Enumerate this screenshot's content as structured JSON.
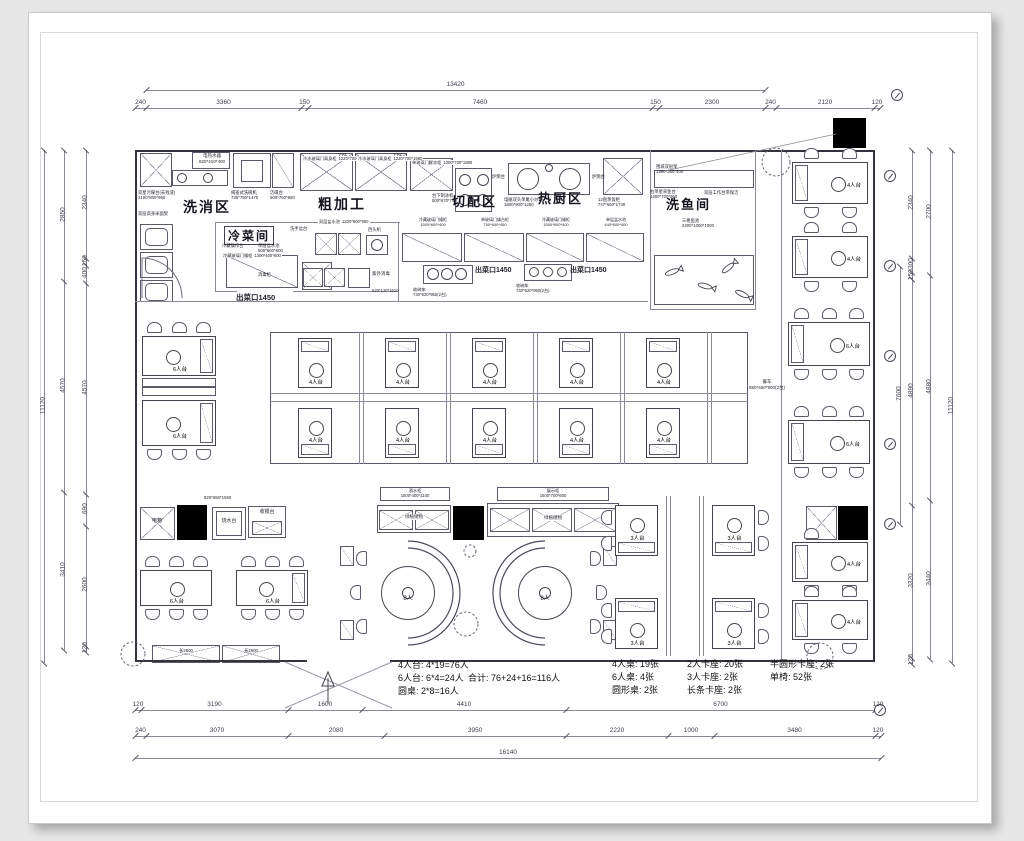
{
  "zones": {
    "wash": "洗消区",
    "cold": "冷菜间",
    "rough": "粗加工",
    "cut": "切配区",
    "hot": "热厨区",
    "fish": "洗鱼间"
  },
  "openings": {
    "serve": "出菜口1450"
  },
  "tables": {
    "t4": "4人台",
    "t6": "6人台",
    "t3": "3人台",
    "round8": "8人"
  },
  "cart": {
    "name": "餐车",
    "dims": "850*450*900(2台)"
  },
  "service": {
    "dianxiang": "电箱",
    "shaoshui": "烧水台",
    "shouyin": "收银台",
    "counter_dims": "820*650*1550",
    "bench": "长2600"
  },
  "shelves": {
    "left_name": "酒水柜",
    "left_dims": "1500*400*1100",
    "right_name": "展示柜",
    "right_dims": "1500*700*600",
    "fill": "绿植储物"
  },
  "equipment": {
    "water_heater": "电热水器",
    "water_heater_dims": "820*410*400",
    "dirty_sink": "双星污碟台(去残渣)",
    "dirty_sink_dims": "2100*800*950",
    "dishwasher": "揭盖式洗碗机",
    "dishwasher_dims": "735*750*1470",
    "clean_table": "洁碟台",
    "clean_table_dims": "600*760*950",
    "rack": "双层高身米面架",
    "freezer": "冷冻玻璃门高身柜",
    "freezer_dims": "1220*700*1980",
    "frl": "FRL",
    "thaw": "单玻璃门解冻柜",
    "thaw_dims": "1000*700*1980",
    "ice": "台下制冰机",
    "ice_dims": "500*670*790",
    "stove_side": "炉倒台",
    "wok": "电磁双头单尾小炒炉",
    "wok_dims": "1800*900*1250",
    "steamer": "12盘蒸饭柜",
    "steamer_dims": "747*650*1740",
    "fish_sink": "右单星采鱼台",
    "fish_sink_dims": "1400*700*950",
    "worktable": "双层工作台带保洁",
    "wall_rack": "围城双层架",
    "wall_rack_dims": "1200*350*400",
    "fish_pond": "三格鱼池",
    "fish_pond_dims": "2300*1000*1000",
    "cold_counter": "冷藏操作台",
    "sink1": "单层盆水池",
    "sink1_dims": "500*600*800",
    "hand_sink": "洗手盆台",
    "sink2": "双层盆水池",
    "sink2_dims": "1200*600*950",
    "mincer": "西头机",
    "low_fridge": "冷藏玻璃门矮柜",
    "low_fridge_dims": "1500*600*400",
    "low_cab": "单玻璃门矮台柜",
    "low_cab_dims": "750*600*450",
    "sink3": "单层盆水池",
    "sink3_dims": "440*600*400",
    "uv": "紫外消毒",
    "uv_dims": "520*120*1610",
    "bowl_cart": "收碗车",
    "bowl_cart_dims": "740*620*950(2台)",
    "disinfect": "消毒柜",
    "low_fridge2": "冷藏玻璃门矮柜",
    "low_fridge2_dims": "1300*400*600"
  },
  "summary": {
    "rows_left": [
      "4人台: 4*19=76人",
      "6人台: 6*4=24人",
      "圆桌: 2*8=16人"
    ],
    "total": "合计: 76+24+16=116人",
    "col1": [
      "4人桌: 19张",
      "6人桌: 4张",
      "圆形桌: 2张"
    ],
    "col2": [
      "2人卡座: 20张",
      "3人卡座: 2张",
      "长条卡座: 2张"
    ],
    "col3": [
      "半圆形卡座: 2张",
      "单椅: 52张"
    ]
  },
  "dims": {
    "top_total": "13420",
    "top": [
      "240",
      "3360",
      "150",
      "7460",
      "150",
      "2300",
      "240",
      "2120",
      "120"
    ],
    "bottom1": [
      "120",
      "3190",
      "1600",
      "4410",
      "6700",
      "120"
    ],
    "bottom2": [
      "240",
      "3070",
      "2080",
      "3950",
      "2220",
      "1000",
      "3480",
      "120"
    ],
    "bottom_total": "16140",
    "left_inner": [
      "2340",
      "150",
      "400",
      "4570",
      "690",
      "2600",
      "120"
    ],
    "left_mid": [
      "2850",
      "4570",
      "3410"
    ],
    "left_total": "11120",
    "right_inner": [
      "2340",
      "300",
      "150",
      "4890",
      "3320",
      "120"
    ],
    "right_mid": [
      "2700",
      "4880",
      "3440"
    ],
    "right_total": "11120",
    "right_span": "7600"
  }
}
